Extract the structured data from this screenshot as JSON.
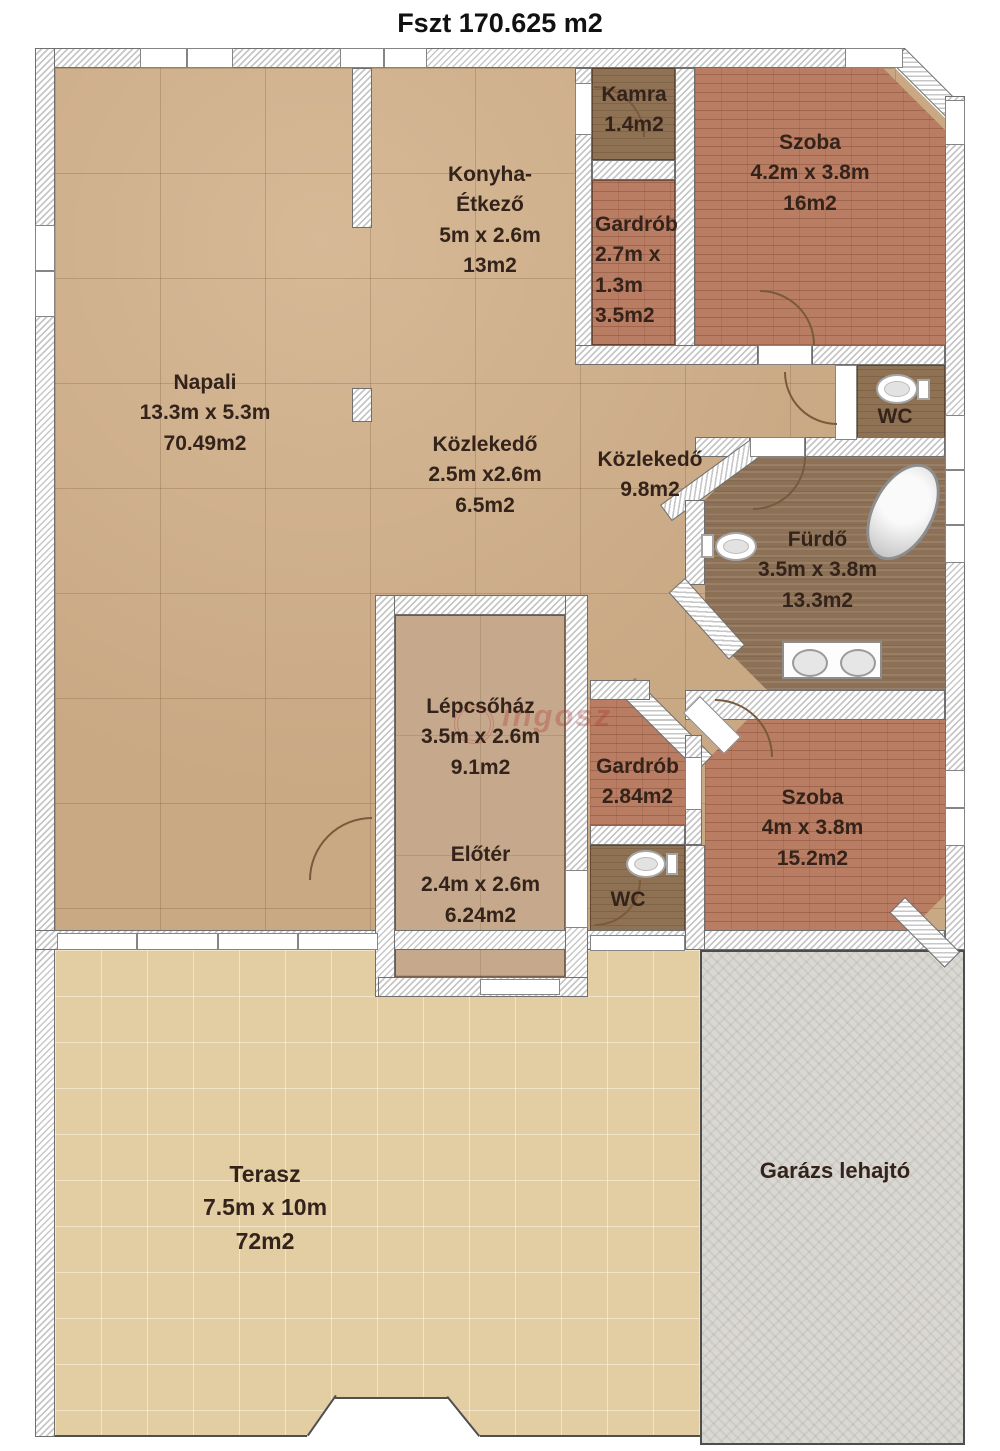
{
  "title": "Fszt 170.625 m2",
  "watermark": "ingosz",
  "colors": {
    "floor_tan": "#c9a884",
    "floor_brick": "#b97d63",
    "floor_brown": "#8f7154",
    "terrace": "#e3cda3",
    "garage": "#dad8d2",
    "wall_hatch_line": "#c7c7c7",
    "label_text": "#34231a"
  },
  "rooms": {
    "napali": {
      "name": "Napali",
      "dims": "13.3m x 5.3m",
      "area": "70.49m2"
    },
    "konyha": {
      "name": "Konyha-",
      "name2": "Étkező",
      "dims": "5m x 2.6m",
      "area": "13m2"
    },
    "kamra": {
      "name": "Kamra",
      "area": "1.4m2"
    },
    "gardrob_top": {
      "name": "Gardrób",
      "dims": "2.7m x",
      "dims2": "1.3m",
      "area": "3.5m2"
    },
    "szoba_top": {
      "name": "Szoba",
      "dims": "4.2m x 3.8m",
      "area": "16m2"
    },
    "kozlekedo_1": {
      "name": "Közlekedő",
      "dims": "2.5m x2.6m",
      "area": "6.5m2"
    },
    "kozlekedo_2": {
      "name": "Közlekedő",
      "area": "9.8m2"
    },
    "wc_top": {
      "name": "WC"
    },
    "furdo": {
      "name": "Fürdő",
      "dims": "3.5m x 3.8m",
      "area": "13.3m2"
    },
    "lepcsohaz": {
      "name": "Lépcsőház",
      "dims": "3.5m x 2.6m",
      "area": "9.1m2"
    },
    "gardrob_bottom": {
      "name": "Gardrób",
      "area": "2.84m2"
    },
    "szoba_bottom": {
      "name": "Szoba",
      "dims": "4m x 3.8m",
      "area": "15.2m2"
    },
    "eloter": {
      "name": "Előtér",
      "dims": "2.4m x 2.6m",
      "area": "6.24m2"
    },
    "wc_bottom": {
      "name": "WC"
    },
    "terasz": {
      "name": "Terasz",
      "dims": "7.5m x 10m",
      "area": "72m2"
    },
    "garazs": {
      "name": "Garázs lehajtó"
    }
  }
}
